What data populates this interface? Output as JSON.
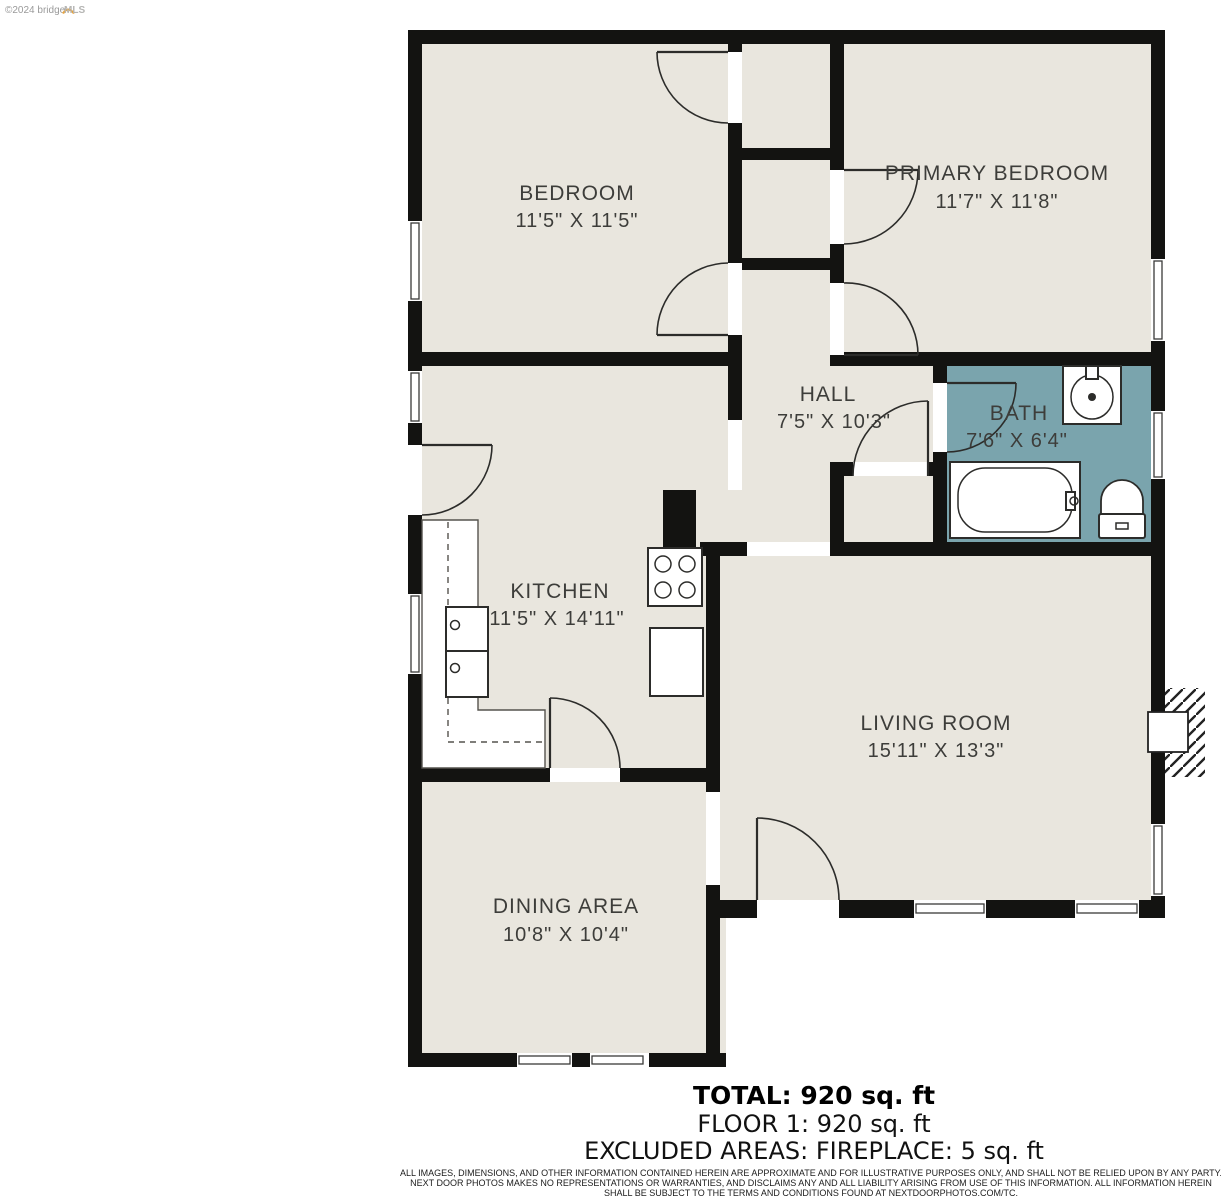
{
  "watermark": {
    "copyright": "©2024 bridge",
    "brand": "MLS"
  },
  "rooms": {
    "bedroom": {
      "name": "BEDROOM",
      "dims": "11'5\" X 11'5\""
    },
    "primary_bedroom": {
      "name": "PRIMARY BEDROOM",
      "dims": "11'7\" X 11'8\""
    },
    "hall": {
      "name": "HALL",
      "dims": "7'5\" X 10'3\""
    },
    "bath": {
      "name": "BATH",
      "dims": "7'6\" X 6'4\""
    },
    "kitchen": {
      "name": "KITCHEN",
      "dims": "11'5\" X 14'11\""
    },
    "living_room": {
      "name": "LIVING ROOM",
      "dims": "15'11\" X 13'3\""
    },
    "dining_area": {
      "name": "DINING AREA",
      "dims": "10'8\" X 10'4\""
    }
  },
  "summary": {
    "total": "TOTAL: 920 sq. ft",
    "floor": "FLOOR 1: 920 sq. ft",
    "excluded": "EXCLUDED AREAS: FIREPLACE: 5 sq. ft"
  },
  "disclaimer": {
    "line1": "ALL IMAGES, DIMENSIONS, AND OTHER INFORMATION CONTAINED HEREIN ARE APPROXIMATE AND FOR ILLUSTRATIVE PURPOSES ONLY, AND SHALL NOT BE RELIED UPON BY ANY PARTY.",
    "line2": "NEXT DOOR PHOTOS MAKES NO REPRESENTATIONS OR WARRANTIES, AND DISCLAIMS ANY AND ALL LIABILITY ARISING FROM USE OF THIS INFORMATION. ALL INFORMATION HEREIN",
    "line3": "SHALL BE SUBJECT TO THE TERMS AND CONDITIONS FOUND AT NEXTDOORPHOTOS.COM/TC."
  },
  "colors": {
    "wall": "#131311",
    "floor": "#e9e6de",
    "bath_floor": "#7aa4ad",
    "label_text": "#3d3d3a",
    "watermark_accent": "#e8a33d"
  }
}
